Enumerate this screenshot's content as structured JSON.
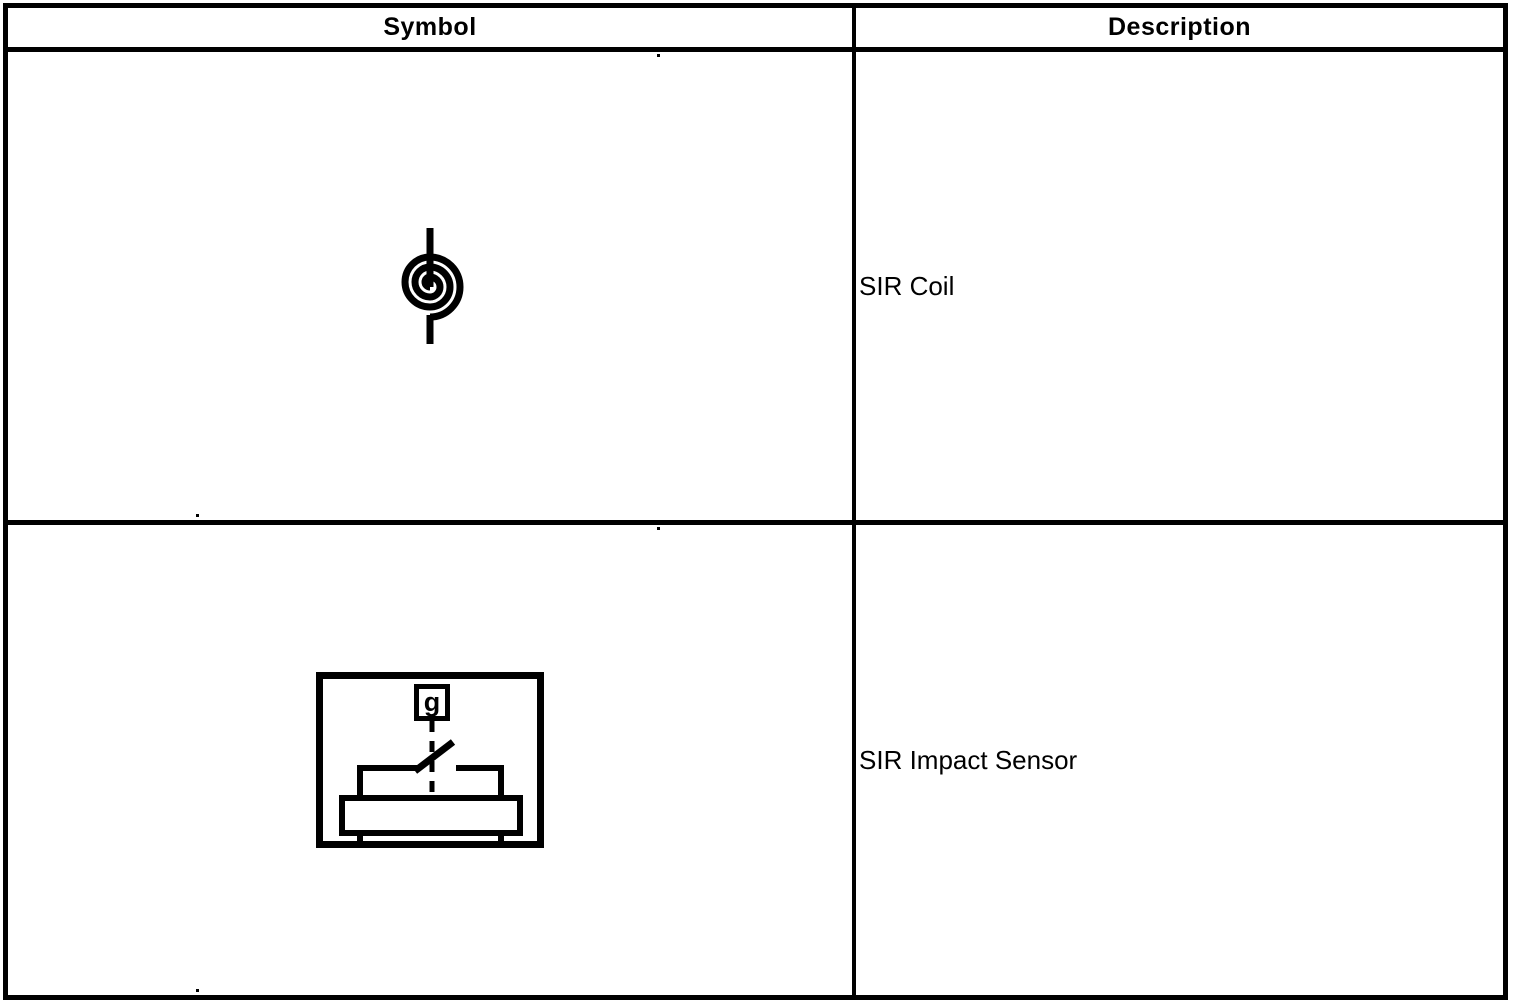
{
  "colors": {
    "ink": "#000000",
    "paper": "#ffffff"
  },
  "table": {
    "headers": [
      {
        "label": "Symbol"
      },
      {
        "label": "Description"
      }
    ],
    "rows": [
      {
        "symbol_icon": "sir-coil-symbol",
        "description": "SIR Coil"
      },
      {
        "symbol_icon": "sir-impact-sensor-symbol",
        "description": "SIR Impact Sensor",
        "sensor_label": "g"
      }
    ]
  }
}
